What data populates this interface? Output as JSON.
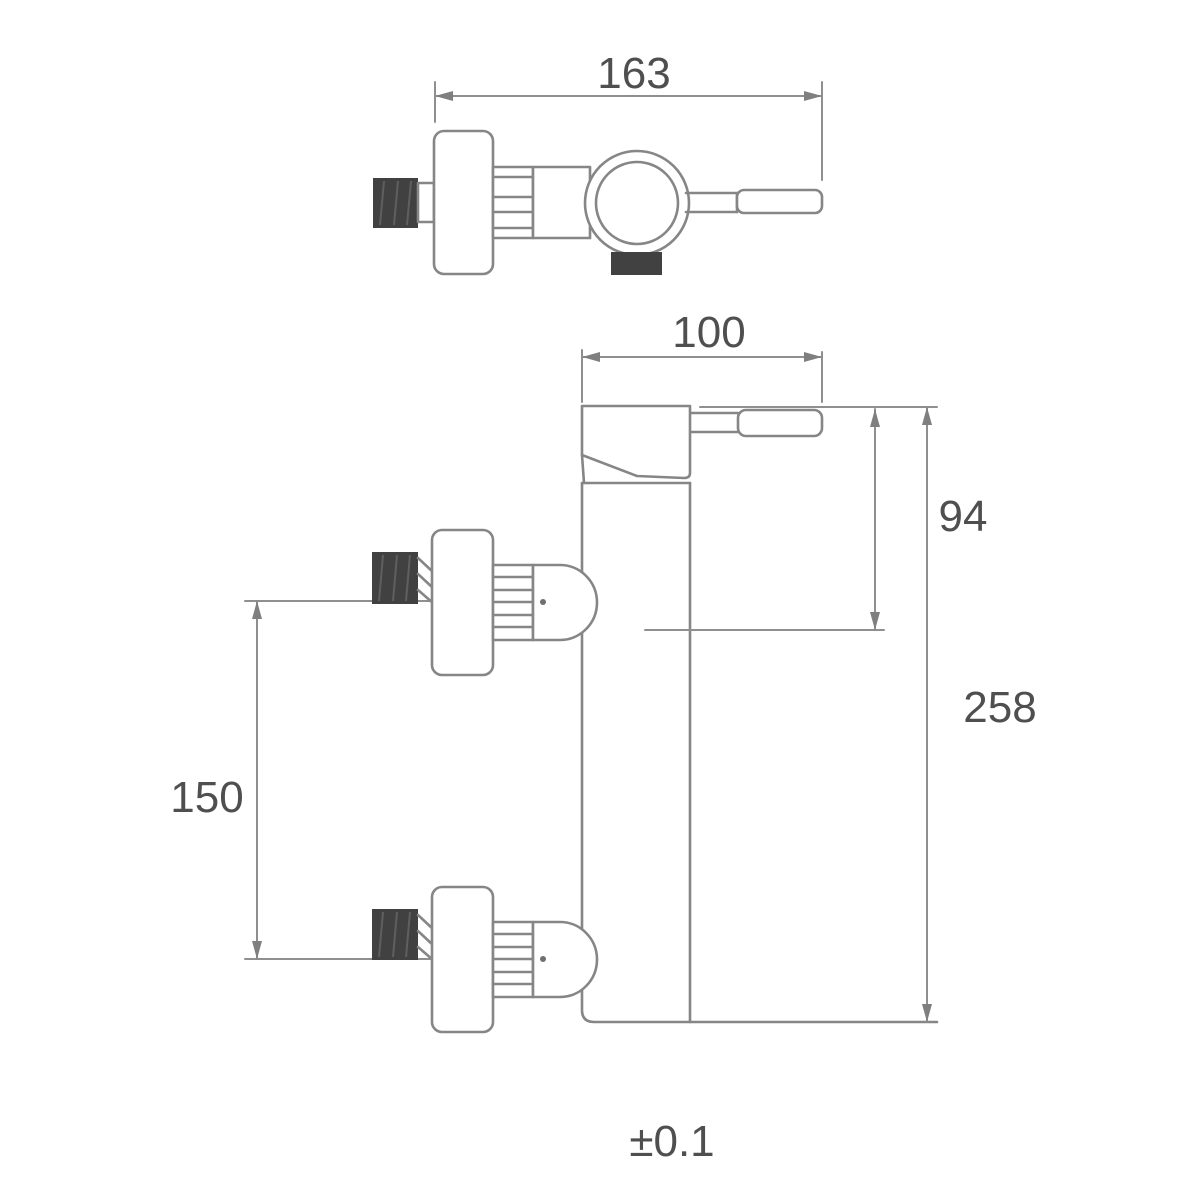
{
  "colors": {
    "background": "#ffffff",
    "drawing_line": "#868686",
    "dimension_line": "#8f8f8f",
    "text": "#4f4f4f",
    "dark_fill": "#414141"
  },
  "top_view": {
    "dim_width": "163"
  },
  "front_view": {
    "dim_head_width": "100",
    "dim_top_to_outlet_center": "94",
    "dim_overall_height": "258",
    "dim_inlet_spacing": "150"
  },
  "tolerance": "±0.1"
}
